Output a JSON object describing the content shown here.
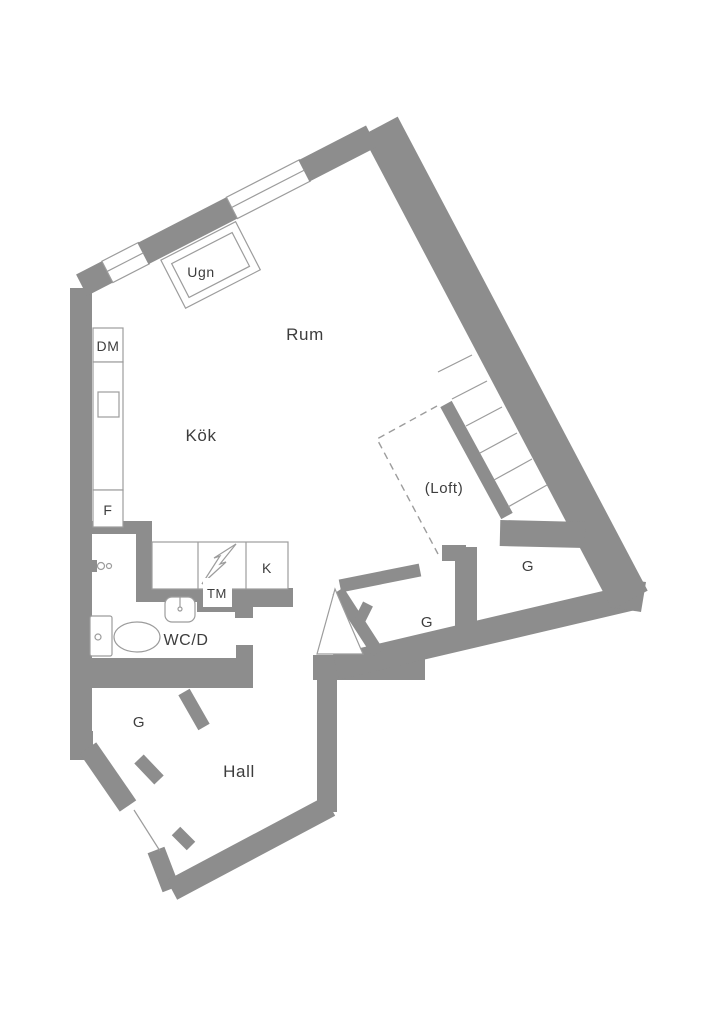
{
  "floor_plan": {
    "colors": {
      "wall": "#8d8d8d",
      "thin_line": "#9c9c9c",
      "text": "#3d3d3d",
      "background": "#ffffff"
    },
    "rooms": {
      "living": "Rum",
      "kitchen": "Kök",
      "hall": "Hall",
      "bath": "WC/D",
      "loft": "(Loft)"
    },
    "appliances": {
      "oven": "Ugn",
      "dishwasher": "DM",
      "freezer": "F",
      "fridge": "K",
      "washer": "TM"
    },
    "closets": {
      "upper_right": "G",
      "mid_right": "G",
      "hall_closet": "G"
    }
  }
}
